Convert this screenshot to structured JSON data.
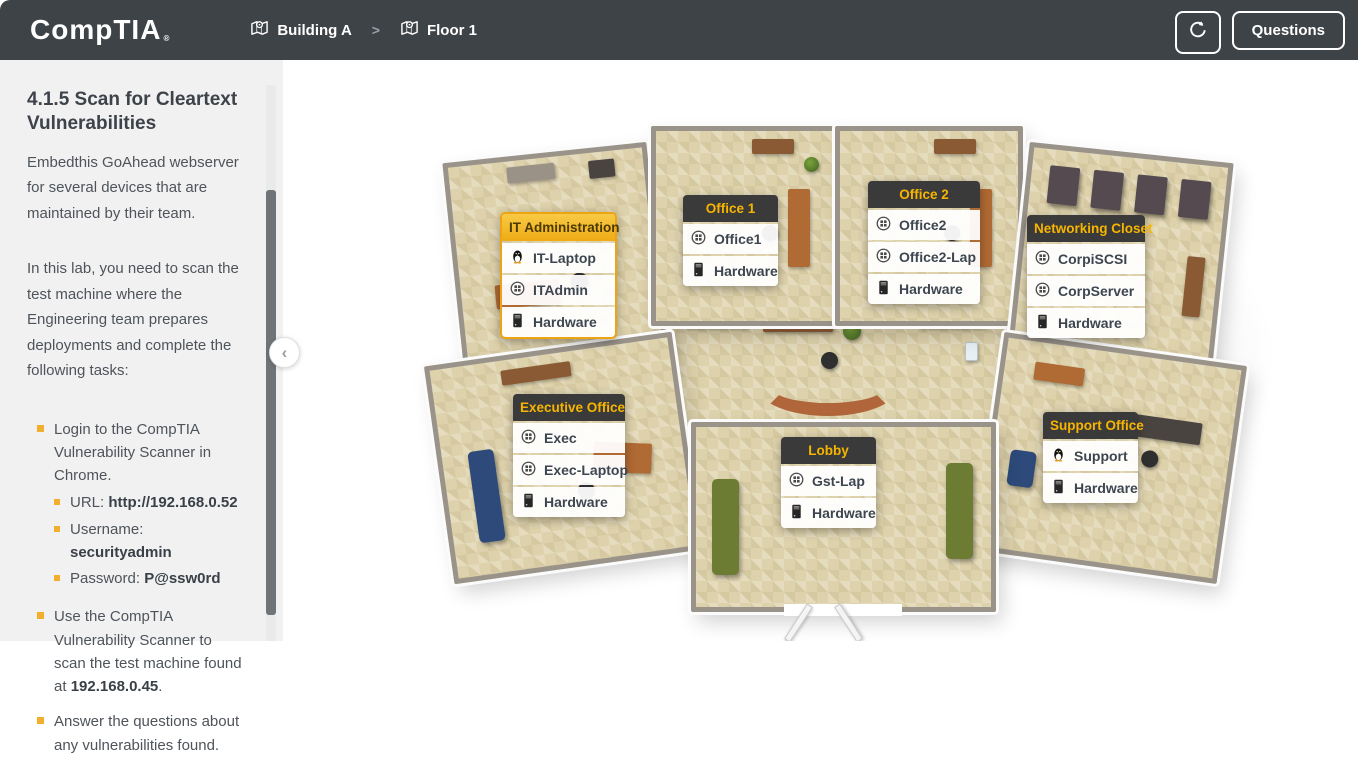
{
  "header": {
    "logo_text": "CompTIA",
    "logo_mark": "®",
    "breadcrumbs": [
      {
        "label": "Building A"
      },
      {
        "label": "Floor 1"
      }
    ],
    "questions_button": "Questions"
  },
  "icons": {
    "breadcrumb_separator": ">",
    "collapse_chevron": "‹"
  },
  "sidebar": {
    "title": "4.1.5 Scan for Cleartext Vulnerabilities",
    "paragraphs": [
      "Embedthis GoAhead webserver for several devices that are maintained by their team.",
      "In this lab, you need to scan the test machine where the Engineering team prepares deployments and complete the following tasks:"
    ],
    "tasks": [
      {
        "text": "Login to the CompTIA Vulnerability Scanner in Chrome.",
        "subtasks": [
          {
            "label": "URL: ",
            "value": "http://192.168.0.52"
          },
          {
            "label": "Username: ",
            "value": "securityadmin"
          },
          {
            "label": "Password: ",
            "value": "P@ssw0rd"
          }
        ]
      },
      {
        "pre": "Use the CompTIA Vulnerability Scanner to scan the test machine found at ",
        "value": "192.168.0.45",
        "post": "."
      },
      {
        "text": "Answer the questions about any vulnerabilities found."
      }
    ]
  },
  "floorplan": {
    "rooms": [
      {
        "name": "IT Administration",
        "highlighted": true,
        "devices": [
          {
            "label": "IT-Laptop",
            "icon": "linux-icon"
          },
          {
            "label": "ITAdmin",
            "icon": "windows-icon"
          },
          {
            "label": "Hardware",
            "icon": "hardware-icon"
          }
        ]
      },
      {
        "name": "Office 1",
        "highlighted": false,
        "devices": [
          {
            "label": "Office1",
            "icon": "windows-icon"
          },
          {
            "label": "Hardware",
            "icon": "hardware-icon"
          }
        ]
      },
      {
        "name": "Office 2",
        "highlighted": false,
        "devices": [
          {
            "label": "Office2",
            "icon": "windows-icon"
          },
          {
            "label": "Office2-Lap",
            "icon": "windows-icon"
          },
          {
            "label": "Hardware",
            "icon": "hardware-icon"
          }
        ]
      },
      {
        "name": "Networking Closet",
        "highlighted": false,
        "devices": [
          {
            "label": "CorpiSCSI",
            "icon": "windows-icon"
          },
          {
            "label": "CorpServer",
            "icon": "windows-icon"
          },
          {
            "label": "Hardware",
            "icon": "hardware-icon"
          }
        ]
      },
      {
        "name": "Executive Office",
        "highlighted": false,
        "devices": [
          {
            "label": "Exec",
            "icon": "windows-icon"
          },
          {
            "label": "Exec-Laptop",
            "icon": "windows-icon"
          },
          {
            "label": "Hardware",
            "icon": "hardware-icon"
          }
        ]
      },
      {
        "name": "Lobby",
        "highlighted": false,
        "devices": [
          {
            "label": "Gst-Lap",
            "icon": "windows-icon"
          },
          {
            "label": "Hardware",
            "icon": "hardware-icon"
          }
        ]
      },
      {
        "name": "Support Office",
        "highlighted": false,
        "devices": [
          {
            "label": "Support",
            "icon": "linux-icon"
          },
          {
            "label": "Hardware",
            "icon": "hardware-icon"
          }
        ]
      }
    ]
  },
  "colors": {
    "topbar_bg": "#3e4347",
    "accent_yellow": "#f2b32a",
    "callout_header_bg": "#3a3a3a",
    "callout_header_text": "#f7b500",
    "bullet": "#f2ae2e",
    "floor_tan": "#ded2ac"
  }
}
